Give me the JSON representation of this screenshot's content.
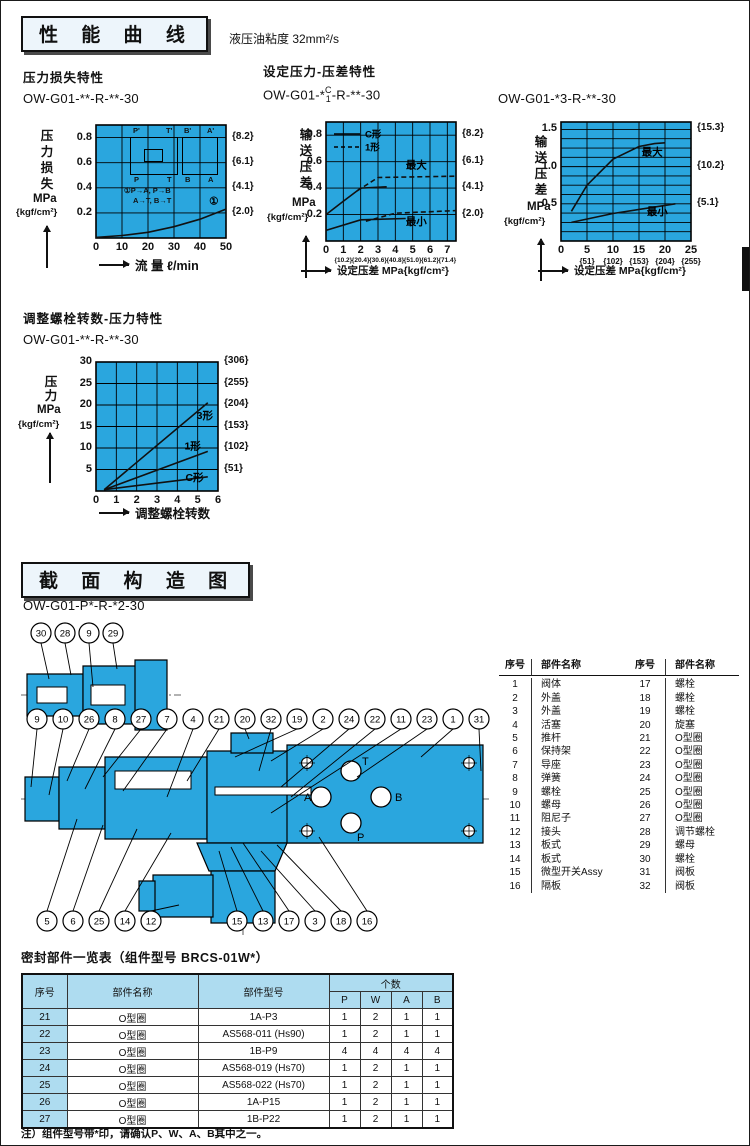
{
  "page": {
    "viscosity_note": "液压油粘度 32mm²/s",
    "footnote": "注）组件型号带*印，请确认P、W、A、B其中之一。"
  },
  "sections": {
    "performance_title": "性 能 曲 线",
    "structure_title": "截 面 构 造 图"
  },
  "colors": {
    "chart_bg": "#2aa6de",
    "table_header_bg": "#aedcf0",
    "diagram_fill": "#2aa6de",
    "line_color": "#111111"
  },
  "charts": {
    "pressure_loss": {
      "subtitle": "压力损失特性",
      "model": "OW-G01-**-R-**-30",
      "y_axis_chars": "压力损失",
      "y_unit": "MPa",
      "y_unit2": "{kgf/cm²}",
      "x_label": "流 量 ℓ/min",
      "schematic": {
        "top_labels": [
          "P'",
          "T'",
          "B'",
          "A'"
        ],
        "bottom_labels": [
          "P",
          "T",
          "B",
          "A"
        ],
        "note1": "①P→A, P→B",
        "note2": "A→T, B→T"
      }
    },
    "set_pressure": {
      "subtitle": "设定压力-压差特性",
      "model_prefix": "OW-G01-*",
      "model_stack_top": "C",
      "model_stack_bottom": "1",
      "model_suffix": "-R-**-30",
      "y_axis_chars": "输送压差",
      "y_unit": "MPa",
      "y_unit2": "{kgf/cm²}",
      "x_label": "设定压差 MPa{kgf/cm²}"
    },
    "set_pressure3": {
      "model": "OW-G01-*3-R-**-30",
      "y_axis_chars": "输送压差",
      "y_unit": "MPa",
      "y_unit2": "{kgf/cm²}",
      "x_label": "设定压差 MPa{kgf/cm²}"
    },
    "bolt_turns": {
      "subtitle": "调整螺栓转数-压力特性",
      "model": "OW-G01-**-R-**-30",
      "y_axis_chars": "压力",
      "y_unit": "MPa",
      "y_unit2": "{kgf/cm²}",
      "x_label": "调整螺栓转数"
    }
  },
  "chart_data": [
    {
      "id": "c1",
      "type": "line",
      "title": "压力损失特性",
      "model": "OW-G01-**-R-**-30",
      "xlabel": "流量 ℓ/min",
      "ylabel": "压力损失 MPa{kgf/cm²}",
      "xlim": [
        0,
        50
      ],
      "ylim": [
        0,
        0.9
      ],
      "xticks": [
        0,
        10,
        20,
        30,
        40,
        50
      ],
      "yticks": [
        0.2,
        0.4,
        0.6,
        0.8
      ],
      "y_bracket_labels": [
        "{2.0}",
        "{4.1}",
        "{6.1}",
        "{8.2}"
      ],
      "grid": true,
      "series": [
        {
          "name": "①",
          "style": "solid",
          "x": [
            0,
            10,
            20,
            30,
            40,
            50
          ],
          "y": [
            0.005,
            0.02,
            0.045,
            0.09,
            0.15,
            0.23
          ]
        }
      ],
      "annotations": [
        {
          "t": "①",
          "x": 43.5,
          "y": 0.265
        }
      ]
    },
    {
      "id": "c2",
      "type": "line",
      "title": "设定压力-压差特性",
      "model": "OW-G01-*C/1-R-**-30",
      "xlabel": "设定压差 MPa{kgf/cm²}",
      "ylabel": "输送压差 MPa{kgf/cm²}",
      "xlim": [
        0,
        7.5
      ],
      "ylim": [
        0,
        0.9
      ],
      "xticks": [
        0,
        1,
        2,
        3,
        4,
        5,
        6,
        7
      ],
      "x_bracket_labels": [
        "{10.2}",
        "{20.4}",
        "{30.6}",
        "{40.8}",
        "{51.0}",
        "{61.2}",
        "{71.4}"
      ],
      "yticks": [
        0.2,
        0.4,
        0.6,
        0.8
      ],
      "y_bracket_labels": [
        "{2.0}",
        "{4.1}",
        "{6.1}",
        "{8.2}"
      ],
      "grid": true,
      "legend": [
        {
          "label": "C形",
          "style": "solid"
        },
        {
          "label": "1形",
          "style": "dashed"
        }
      ],
      "series": [
        {
          "name": "C形最大",
          "style": "solid",
          "x": [
            0,
            1,
            2,
            3.5
          ],
          "y": [
            0.2,
            0.3,
            0.4,
            0.41
          ]
        },
        {
          "name": "1形最大",
          "style": "dashed",
          "x": [
            1.8,
            3,
            7.5
          ],
          "y": [
            0.38,
            0.48,
            0.49
          ]
        },
        {
          "name": "C形最小",
          "style": "solid",
          "x": [
            0,
            2,
            4.6
          ],
          "y": [
            0.08,
            0.16,
            0.17
          ]
        },
        {
          "name": "1形最小",
          "style": "dashed",
          "x": [
            2.3,
            4,
            7.5
          ],
          "y": [
            0.15,
            0.21,
            0.23
          ]
        }
      ],
      "annotations": [
        {
          "t": "最大",
          "x": 4.6,
          "y": 0.55
        },
        {
          "t": "最小",
          "x": 4.6,
          "y": 0.12
        }
      ]
    },
    {
      "id": "c3",
      "type": "line",
      "title": "OW-G01-*3-R-**-30",
      "model": "OW-G01-*3-R-**-30",
      "xlabel": "设定压差 MPa{kgf/cm²}",
      "ylabel": "输送压差 MPa{kgf/cm²}",
      "xlim": [
        0,
        25
      ],
      "ylim": [
        0,
        1.6
      ],
      "xticks": [
        0,
        5,
        10,
        15,
        20,
        25
      ],
      "x_bracket_labels": [
        "{51}",
        "{102}",
        "{153}",
        "{204}",
        "{255}"
      ],
      "yticks": [
        0.5,
        1.0,
        1.5
      ],
      "y_bracket_labels": [
        "{5.1}",
        "{10.2}",
        "{15.3}"
      ],
      "grid": true,
      "series": [
        {
          "name": "最大",
          "style": "solid",
          "x": [
            2,
            5,
            10,
            15,
            18,
            20
          ],
          "y": [
            0.4,
            0.75,
            1.1,
            1.27,
            1.31,
            1.32
          ]
        },
        {
          "name": "最小",
          "style": "solid",
          "x": [
            2,
            10,
            22
          ],
          "y": [
            0.25,
            0.37,
            0.5
          ]
        }
      ],
      "annotations": [
        {
          "t": "最大",
          "x": 15.5,
          "y": 1.15
        },
        {
          "t": "最小",
          "x": 16.5,
          "y": 0.35
        }
      ]
    },
    {
      "id": "c4",
      "type": "line",
      "title": "调整螺栓转数-压力特性",
      "model": "OW-G01-**-R-**-30",
      "xlabel": "调整螺栓转数",
      "ylabel": "压力 MPa{kgf/cm²}",
      "xlim": [
        0,
        6
      ],
      "ylim": [
        0,
        30
      ],
      "xticks": [
        0,
        1,
        2,
        3,
        4,
        5,
        6
      ],
      "yticks": [
        5,
        10,
        15,
        20,
        25,
        30
      ],
      "y_bracket_labels": [
        "{51}",
        "{102}",
        "{153}",
        "{204}",
        "{255}",
        "{306}"
      ],
      "grid": true,
      "series": [
        {
          "name": "3形",
          "style": "solid",
          "x": [
            0.4,
            5.5
          ],
          "y": [
            0.3,
            20.5
          ]
        },
        {
          "name": "1形",
          "style": "solid",
          "x": [
            0.4,
            5.5
          ],
          "y": [
            0.3,
            9.2
          ]
        },
        {
          "name": "C形",
          "style": "solid",
          "x": [
            0.4,
            5.5
          ],
          "y": [
            0.3,
            3.3
          ]
        }
      ],
      "annotations": [
        {
          "t": "3形",
          "x": 4.95,
          "y": 16.8
        },
        {
          "t": "1形",
          "x": 4.35,
          "y": 9.6
        },
        {
          "t": "C形",
          "x": 4.4,
          "y": 2.3
        }
      ]
    }
  ],
  "structure": {
    "model": "OW-G01-P*-R-*2-30",
    "callouts_top": [
      "30",
      "28",
      "9",
      "29"
    ],
    "callouts_mid": [
      "9",
      "10",
      "26",
      "8",
      "27",
      "7",
      "4",
      "21",
      "20",
      "32",
      "19",
      "2",
      "24",
      "22",
      "11",
      "23",
      "1",
      "31"
    ],
    "callouts_bottom_left": [
      "5",
      "6",
      "25",
      "14",
      "12"
    ],
    "callouts_bottom_right": [
      "15",
      "13",
      "17",
      "3",
      "18",
      "16"
    ],
    "ports": [
      "T",
      "A",
      "B",
      "P"
    ]
  },
  "parts_table": {
    "col_headers": [
      "序号",
      "部件名称"
    ],
    "left_rows": [
      [
        "1",
        "阀体"
      ],
      [
        "2",
        "外盖"
      ],
      [
        "3",
        "外盖"
      ],
      [
        "4",
        "活塞"
      ],
      [
        "5",
        "推杆"
      ],
      [
        "6",
        "保持架"
      ],
      [
        "7",
        "导座"
      ],
      [
        "8",
        "弹簧"
      ],
      [
        "9",
        "螺栓"
      ],
      [
        "10",
        "螺母"
      ],
      [
        "11",
        "阻尼子"
      ],
      [
        "12",
        "接头"
      ],
      [
        "13",
        "板式"
      ],
      [
        "14",
        "板式"
      ],
      [
        "15",
        "微型开关Assy"
      ],
      [
        "16",
        "隔板"
      ]
    ],
    "right_rows": [
      [
        "17",
        "螺栓"
      ],
      [
        "18",
        "螺栓"
      ],
      [
        "19",
        "螺栓"
      ],
      [
        "20",
        "旋塞"
      ],
      [
        "21",
        "O型圈"
      ],
      [
        "22",
        "O型圈"
      ],
      [
        "23",
        "O型圈"
      ],
      [
        "24",
        "O型圈"
      ],
      [
        "25",
        "O型圈"
      ],
      [
        "26",
        "O型圈"
      ],
      [
        "27",
        "O型圈"
      ],
      [
        "28",
        "调节螺栓"
      ],
      [
        "29",
        "螺母"
      ],
      [
        "30",
        "螺栓"
      ],
      [
        "31",
        "阀板"
      ],
      [
        "32",
        "阀板"
      ]
    ]
  },
  "seal_table": {
    "title": "密封部件一览表（组件型号 BRCS-01W*）",
    "headers": {
      "no": "序号",
      "name": "部件名称",
      "model": "部件型号",
      "qty": "个数",
      "qty_cols": [
        "P",
        "W",
        "A",
        "B"
      ]
    },
    "rows": [
      [
        "21",
        "O型圈",
        "1A-P3",
        "1",
        "2",
        "1",
        "1"
      ],
      [
        "22",
        "O型圈",
        "AS568-011 (Hs90)",
        "1",
        "2",
        "1",
        "1"
      ],
      [
        "23",
        "O型圈",
        "1B-P9",
        "4",
        "4",
        "4",
        "4"
      ],
      [
        "24",
        "O型圈",
        "AS568-019 (Hs70)",
        "1",
        "2",
        "1",
        "1"
      ],
      [
        "25",
        "O型圈",
        "AS568-022 (Hs70)",
        "1",
        "2",
        "1",
        "1"
      ],
      [
        "26",
        "O型圈",
        "1A-P15",
        "1",
        "2",
        "1",
        "1"
      ],
      [
        "27",
        "O型圈",
        "1B-P22",
        "1",
        "2",
        "1",
        "1"
      ]
    ]
  }
}
